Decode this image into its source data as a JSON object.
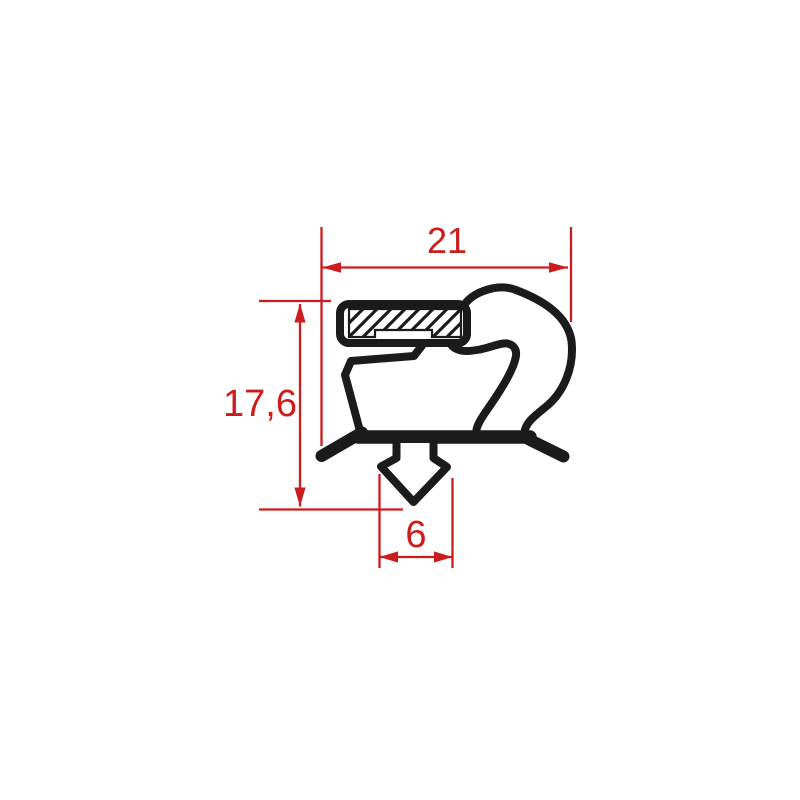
{
  "diagram": {
    "kind": "gasket-profile-cross-section",
    "dimensions": {
      "top_width": "21",
      "left_height": "17,6",
      "bottom_width": "6"
    },
    "colors": {
      "dimension": "#cc1c1c",
      "profile": "#1b1b1b",
      "background": "#ffffff"
    }
  }
}
